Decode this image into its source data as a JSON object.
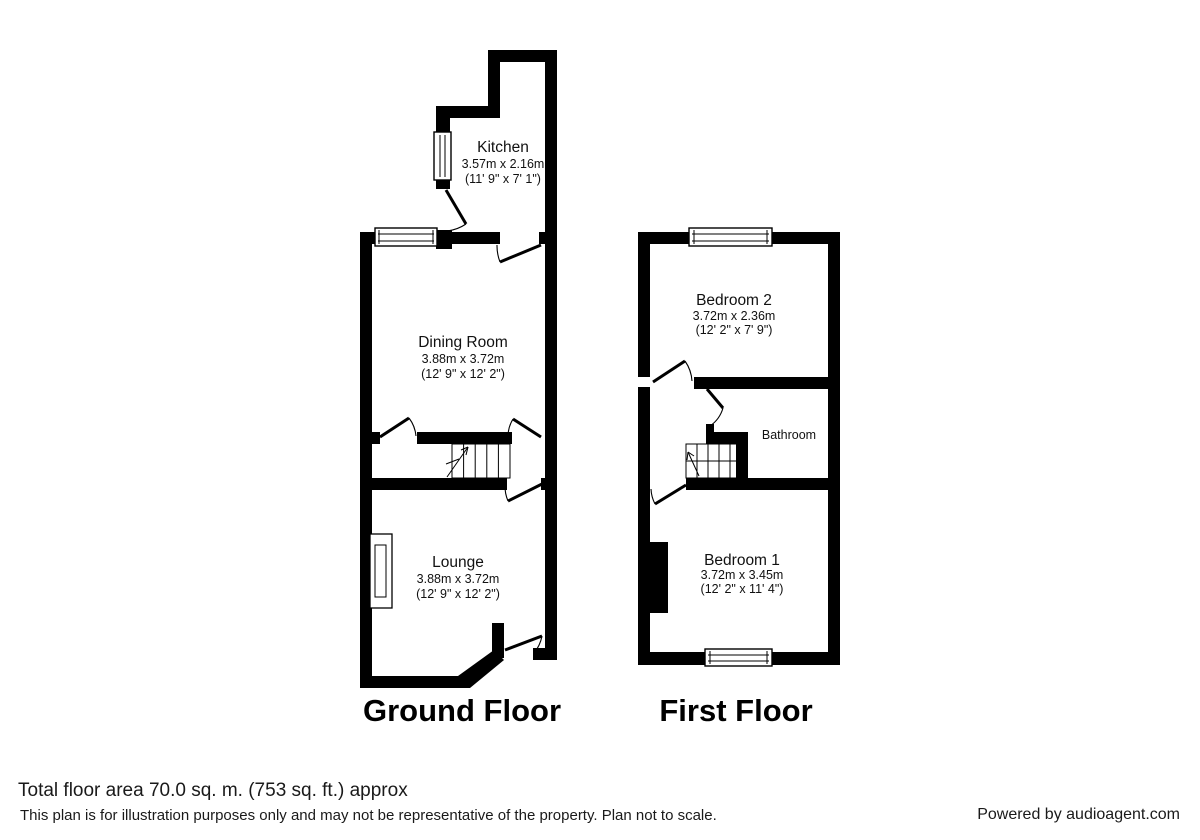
{
  "plan": {
    "floors": [
      {
        "title": "Ground Floor",
        "rooms": [
          {
            "name": "Kitchen",
            "size_metric": "3.57m x 2.16m",
            "size_imperial": "(11' 9\" x 7' 1\")"
          },
          {
            "name": "Dining Room",
            "size_metric": "3.88m x 3.72m",
            "size_imperial": "(12' 9\" x 12' 2\")"
          },
          {
            "name": "Lounge",
            "size_metric": "3.88m x 3.72m",
            "size_imperial": "(12' 9\" x 12' 2\")"
          }
        ]
      },
      {
        "title": "First Floor",
        "rooms": [
          {
            "name": "Bedroom 2",
            "size_metric": "3.72m x 2.36m",
            "size_imperial": "(12' 2\" x 7' 9\")"
          },
          {
            "name": "Bathroom",
            "size_metric": "",
            "size_imperial": ""
          },
          {
            "name": "Bedroom 1",
            "size_metric": "3.72m x 3.45m",
            "size_imperial": "(12' 2\" x 11' 4\")"
          }
        ]
      }
    ]
  },
  "footer": {
    "total_area": "Total floor area 70.0 sq. m. (753 sq. ft.) approx",
    "disclaimer": "This plan is for illustration purposes only and may not be representative of the property. Plan not to scale.",
    "credit": "Powered by audioagent.com"
  },
  "colors": {
    "wall": "#000000",
    "background": "#ffffff"
  }
}
